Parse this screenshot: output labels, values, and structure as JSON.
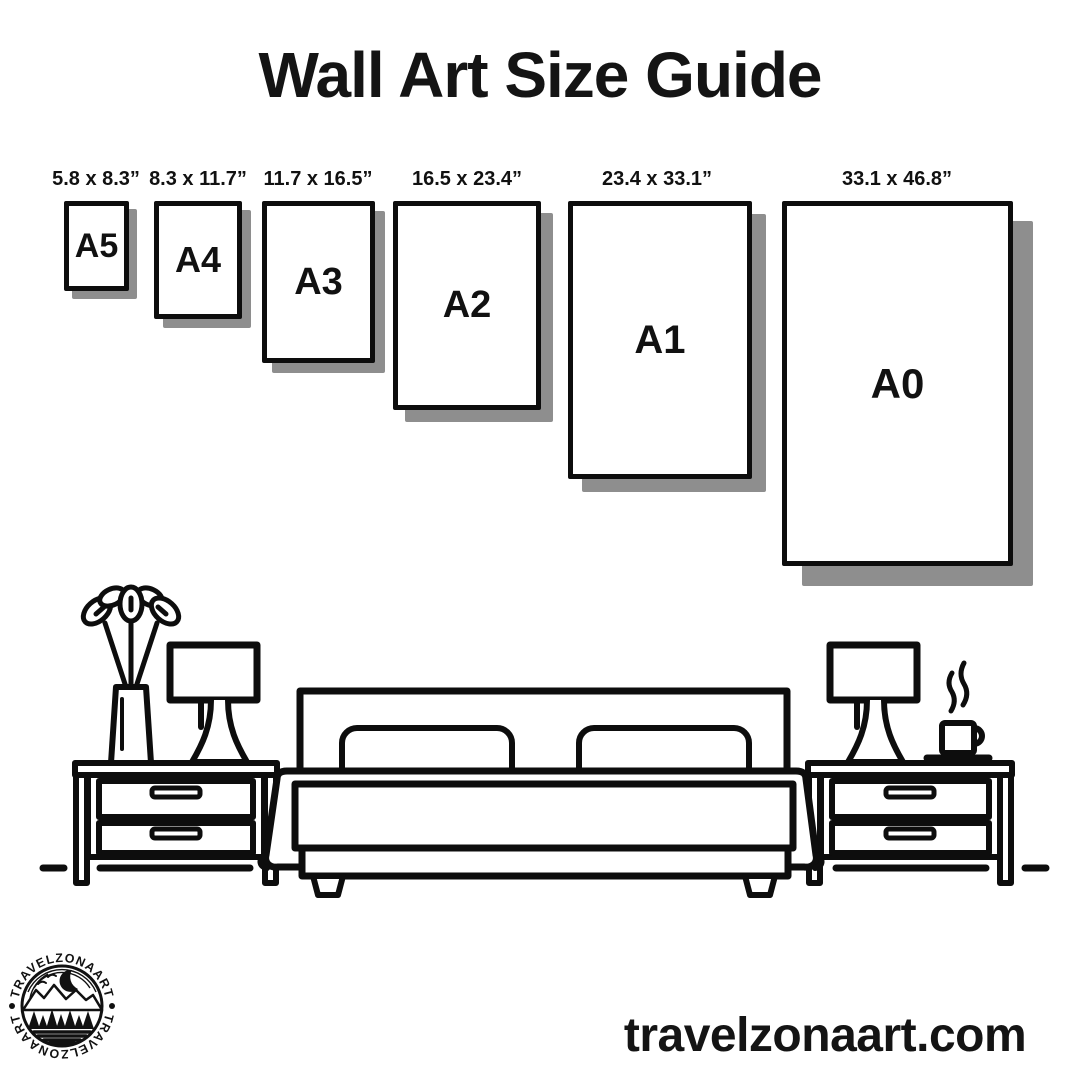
{
  "title": "Wall Art Size Guide",
  "sizes": [
    {
      "code": "A5",
      "dimensions": "5.8 x 8.3”"
    },
    {
      "code": "A4",
      "dimensions": "8.3 x 11.7”"
    },
    {
      "code": "A3",
      "dimensions": "11.7 x 16.5”"
    },
    {
      "code": "A2",
      "dimensions": "16.5 x 23.4”"
    },
    {
      "code": "A1",
      "dimensions": "23.4 x 33.1”"
    },
    {
      "code": "A0",
      "dimensions": "33.1 x 46.8”"
    }
  ],
  "illustration": {
    "icons": [
      "plant-icon",
      "table-lamp-icon",
      "nightstand-icon",
      "bed-icon",
      "pillow-icon",
      "coffee-mug-icon",
      "steam-icon",
      "floor-line"
    ]
  },
  "logo": {
    "badge_text_top": "TRAVELZONAART",
    "badge_text_bottom": "TRAVELZONAART"
  },
  "website": "travelzonaart.com",
  "colors": {
    "ink": "#0d0d0d",
    "shadow": "#8e8e8e",
    "background": "#ffffff"
  }
}
